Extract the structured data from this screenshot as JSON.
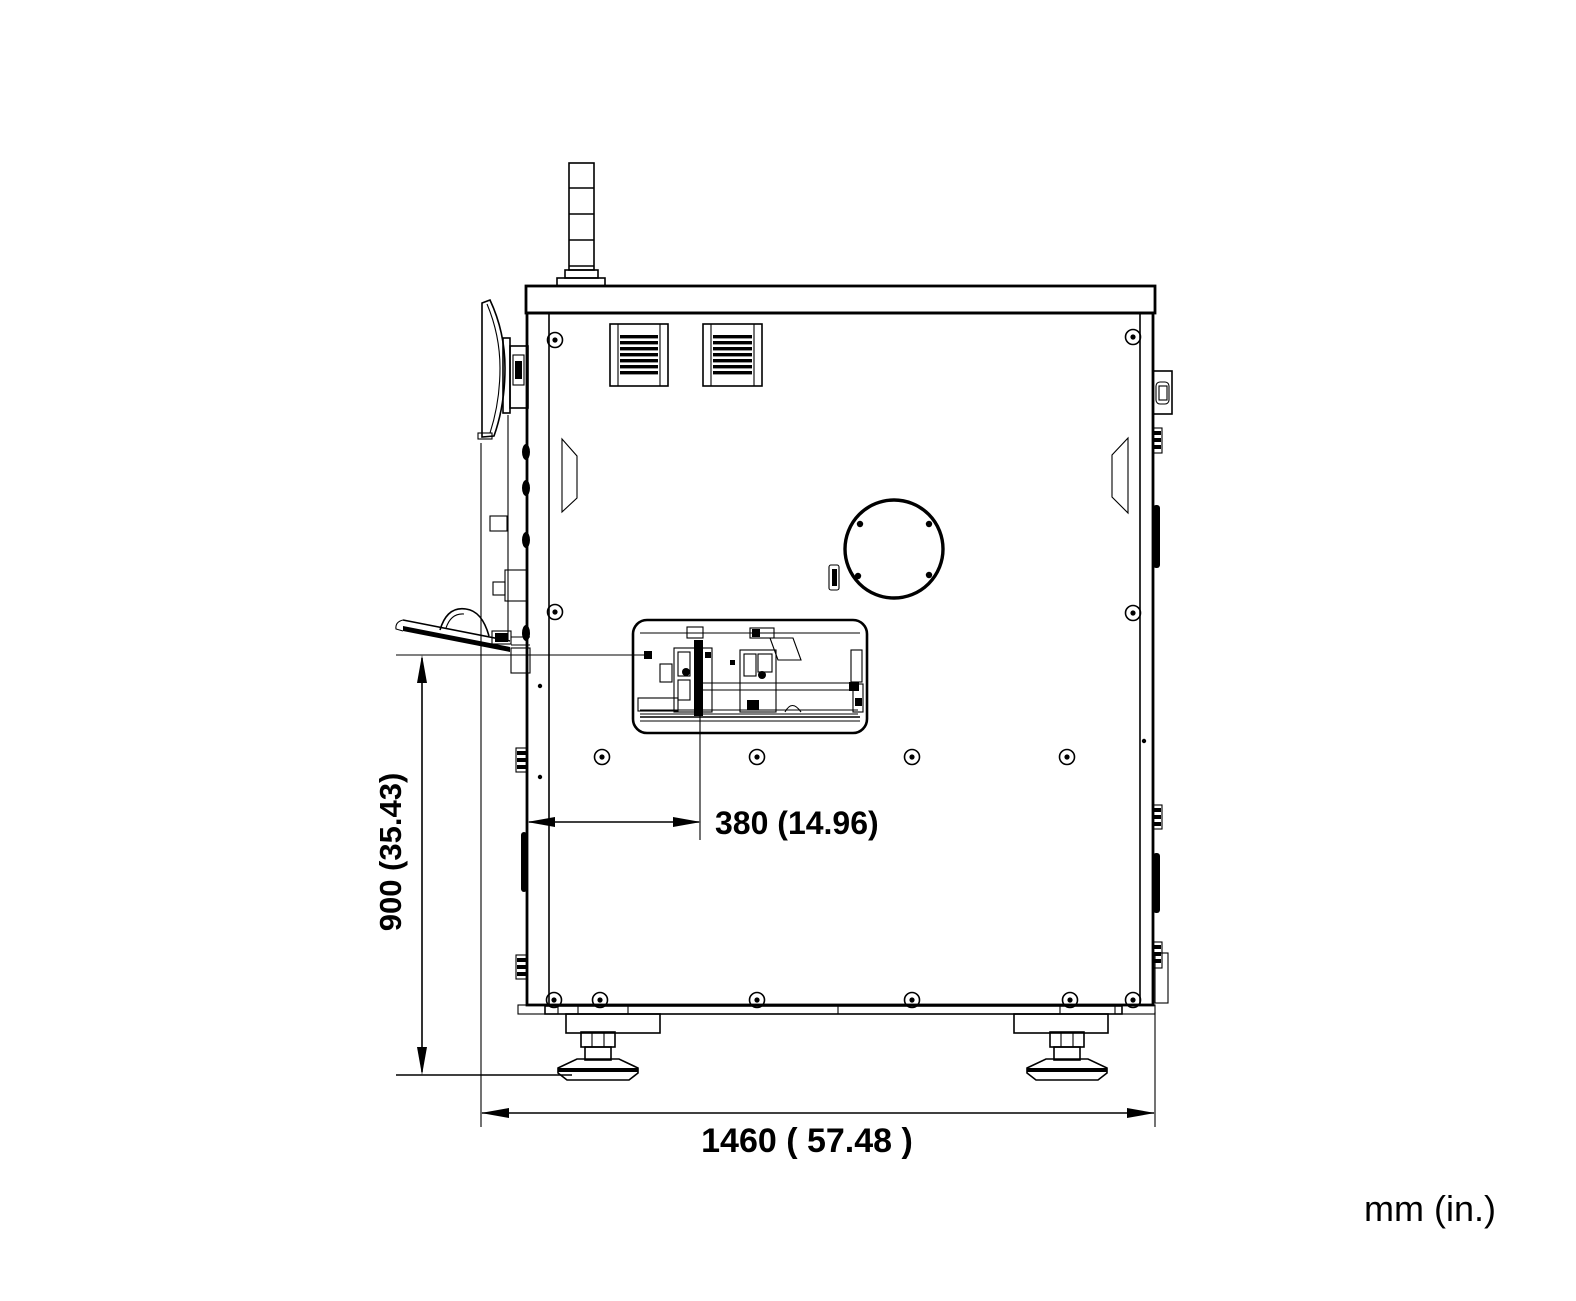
{
  "drawing": {
    "type": "technical-drawing",
    "view": "machine-side-elevation",
    "units_label": "mm (in.)",
    "dimensions": {
      "height": {
        "label": "900 (35.43)",
        "mm": 900,
        "inches": 35.43,
        "orientation": "vertical"
      },
      "offset": {
        "label": "380 (14.96)",
        "mm": 380,
        "inches": 14.96,
        "orientation": "horizontal"
      },
      "width": {
        "label": "1460 ( 57.48 )",
        "mm": 1460,
        "inches": 57.48,
        "orientation": "horizontal"
      }
    },
    "colors": {
      "line": "#000000",
      "background": "#ffffff"
    }
  }
}
